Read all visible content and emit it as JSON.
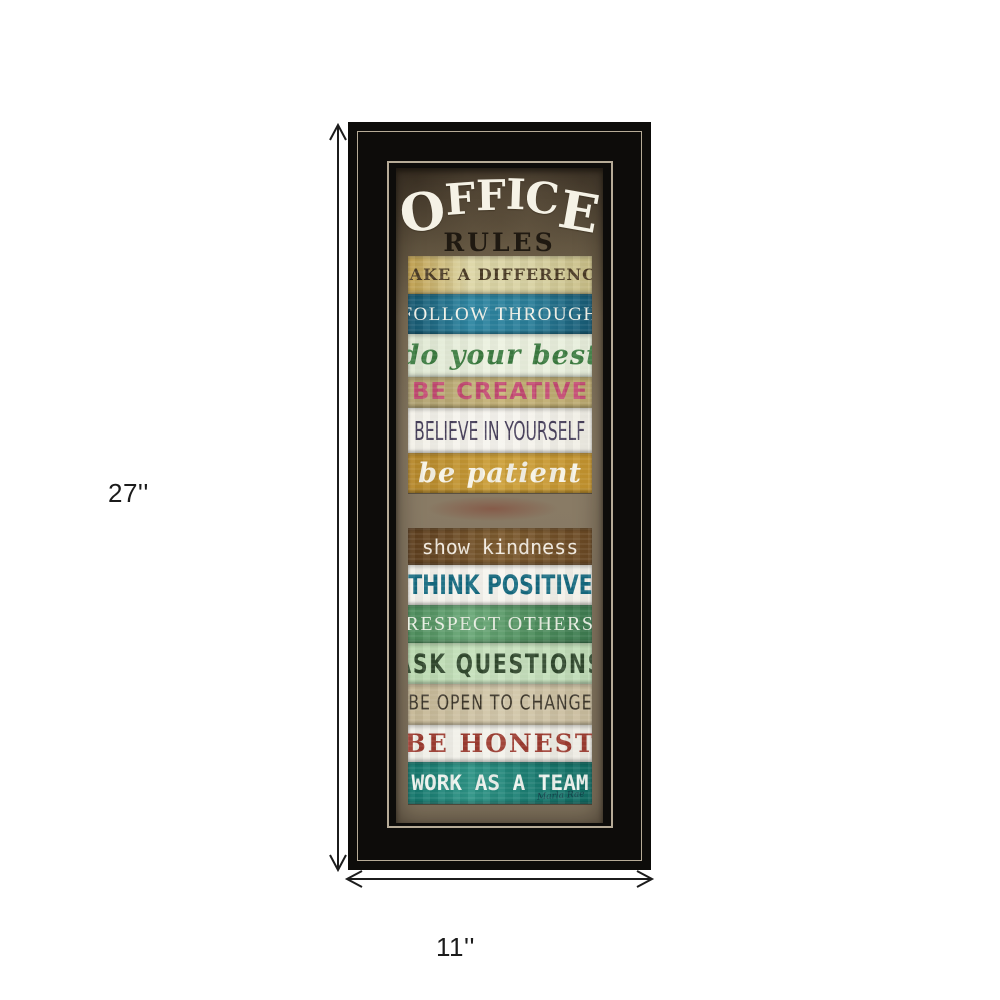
{
  "dimension_annotations": {
    "height_label": "27''",
    "width_label": "11''",
    "arrow_color": "#1c1c1c"
  },
  "frame": {
    "frame_color": "#0d0c0a",
    "pinstripe_color": "#b6ab97"
  },
  "artwork": {
    "background_color": "#84765f",
    "title": {
      "line1": "OFFICE",
      "line1_color": "#f5f2e6",
      "line2": "RULES",
      "line2_color": "#1f1911"
    },
    "strips": [
      {
        "text": "MAKE A DIFFERENCE",
        "fg": "#4b3b25",
        "bg": [
          "#bd9c4a",
          "#ddd6a6",
          "#d8d2a2",
          "#c8bd85"
        ]
      },
      {
        "text": "FOLLOW THROUGH",
        "fg": "#f5f4ea",
        "bg": [
          "#15566e",
          "#2e86a2",
          "#2a7e99",
          "#175a74"
        ]
      },
      {
        "text": "do your best",
        "fg": "#3c7c41",
        "bg": [
          "#dfe8d2",
          "#edf2e1",
          "#e6edda"
        ]
      },
      {
        "text": "BE CREATIVE",
        "fg": "#c34a71",
        "bg": [
          "#b0a171",
          "#c7b478",
          "#bba96f"
        ]
      },
      {
        "text": "BELIEVE IN YOURSELF",
        "fg": "#48405c",
        "bg": [
          "#f2f0e8",
          "#f7f5ef",
          "#efede4"
        ]
      },
      {
        "text": "be patient",
        "fg": "#f7f3e6",
        "bg": [
          "#b5872a",
          "#cda039",
          "#c3932e"
        ]
      },
      {
        "text": "show kindness",
        "fg": "#f1eadf",
        "bg": [
          "#5d3e1e",
          "#7d5b2f",
          "#694823"
        ]
      },
      {
        "text": "THINK POSITIVE",
        "fg": "#156a80",
        "bg": [
          "#f3f1ea",
          "#f7f5ef",
          "#f1efe7"
        ]
      },
      {
        "text": "RESPECT OTHERS",
        "fg": "#e9efe3",
        "bg": [
          "#4a8a59",
          "#6aa877",
          "#4f8f5e",
          "#3c7a4f"
        ]
      },
      {
        "text": "ASK QUESTIONS",
        "fg": "#31492e",
        "bg": [
          "#b8d8ae",
          "#cae3c0",
          "#bedbb5"
        ]
      },
      {
        "text": "BE OPEN TO CHANGE",
        "fg": "#3d372b",
        "bg": [
          "#c5b795",
          "#d3c8ab",
          "#c9bc9d"
        ]
      },
      {
        "text": "BE HONEST",
        "fg": "#9d3b30",
        "bg": [
          "#efeee7",
          "#f3f2eb",
          "#eceae2"
        ]
      },
      {
        "text": "WORK AS A TEAM",
        "fg": "#edf3ee",
        "bg": [
          "#13756b",
          "#2e9486",
          "#1b7d72",
          "#116b62"
        ]
      }
    ],
    "signature": "Marla Rae"
  }
}
